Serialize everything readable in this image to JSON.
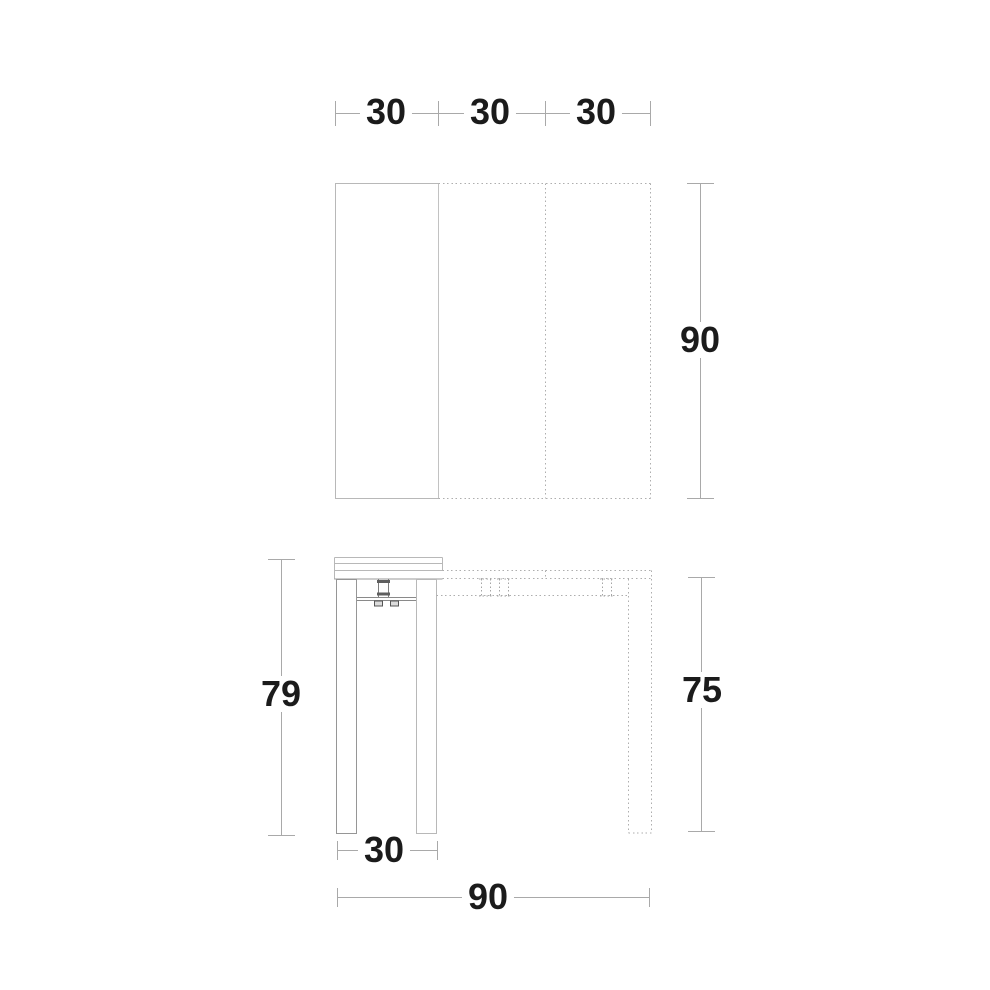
{
  "drawing": {
    "type": "furniture-technical-drawing",
    "views": {
      "plan_view": {
        "description": "top view of extendable console table top, three leaves",
        "segment_dims": [
          "30",
          "30",
          "30"
        ],
        "depth_dim": "90"
      },
      "elevation_view": {
        "description": "side view of console table closed (solid) and extended (dotted)",
        "overall_height_dim": "79",
        "table_height_dim": "75",
        "closed_width_dim": "30",
        "extended_width_dim": "90"
      }
    },
    "colors": {
      "background": "#ffffff",
      "line_light": "#b8b8b8",
      "line_medium": "#9a9a9a",
      "line_dark": "#5f5f5f",
      "dimension_line": "#a9a9a9",
      "text": "#1b1b1b"
    }
  }
}
